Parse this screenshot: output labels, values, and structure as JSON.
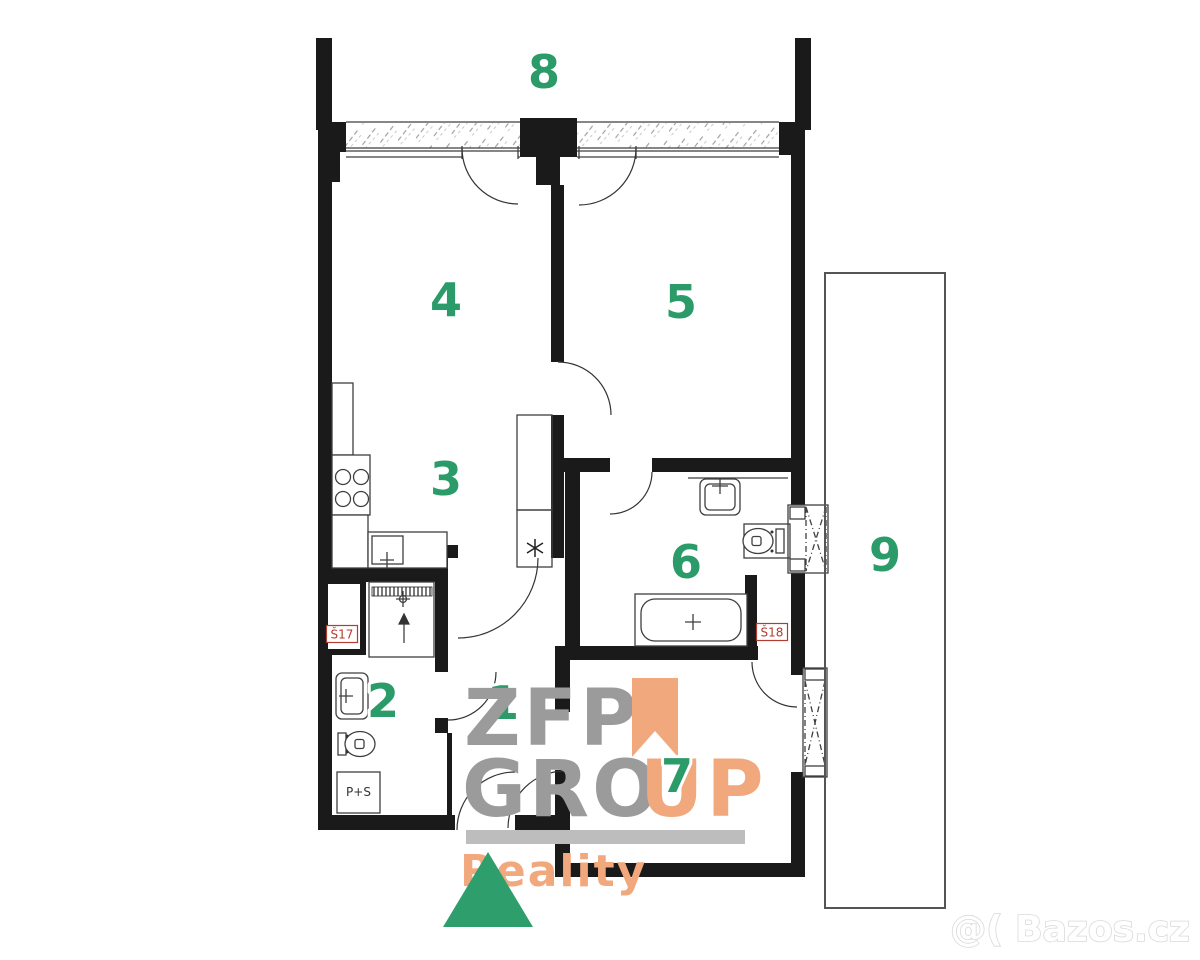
{
  "plan": {
    "room_labels": {
      "r1": "1",
      "r2": "2",
      "r3": "3",
      "r4": "4",
      "r5": "5",
      "r6": "6",
      "r7": "7",
      "r8": "8",
      "r9": "9"
    },
    "label_color": "#2b9b69",
    "shaft_labels": {
      "s17": "Š17",
      "s18": "Š18"
    },
    "shaft_label_color": "#b23c2e",
    "appliance_box_label": "P+S"
  },
  "watermarks": {
    "logo": {
      "line1": "ZFP",
      "line2_gray": "GRO",
      "line2_orange": "UP",
      "line3": "Reality",
      "gray": "#9b9b9b",
      "orange": "#f2a87d",
      "bar": "#bdbdbd",
      "green_triangle": "#2f9e6d"
    },
    "site": {
      "text": "@( Bazos.cz"
    }
  }
}
